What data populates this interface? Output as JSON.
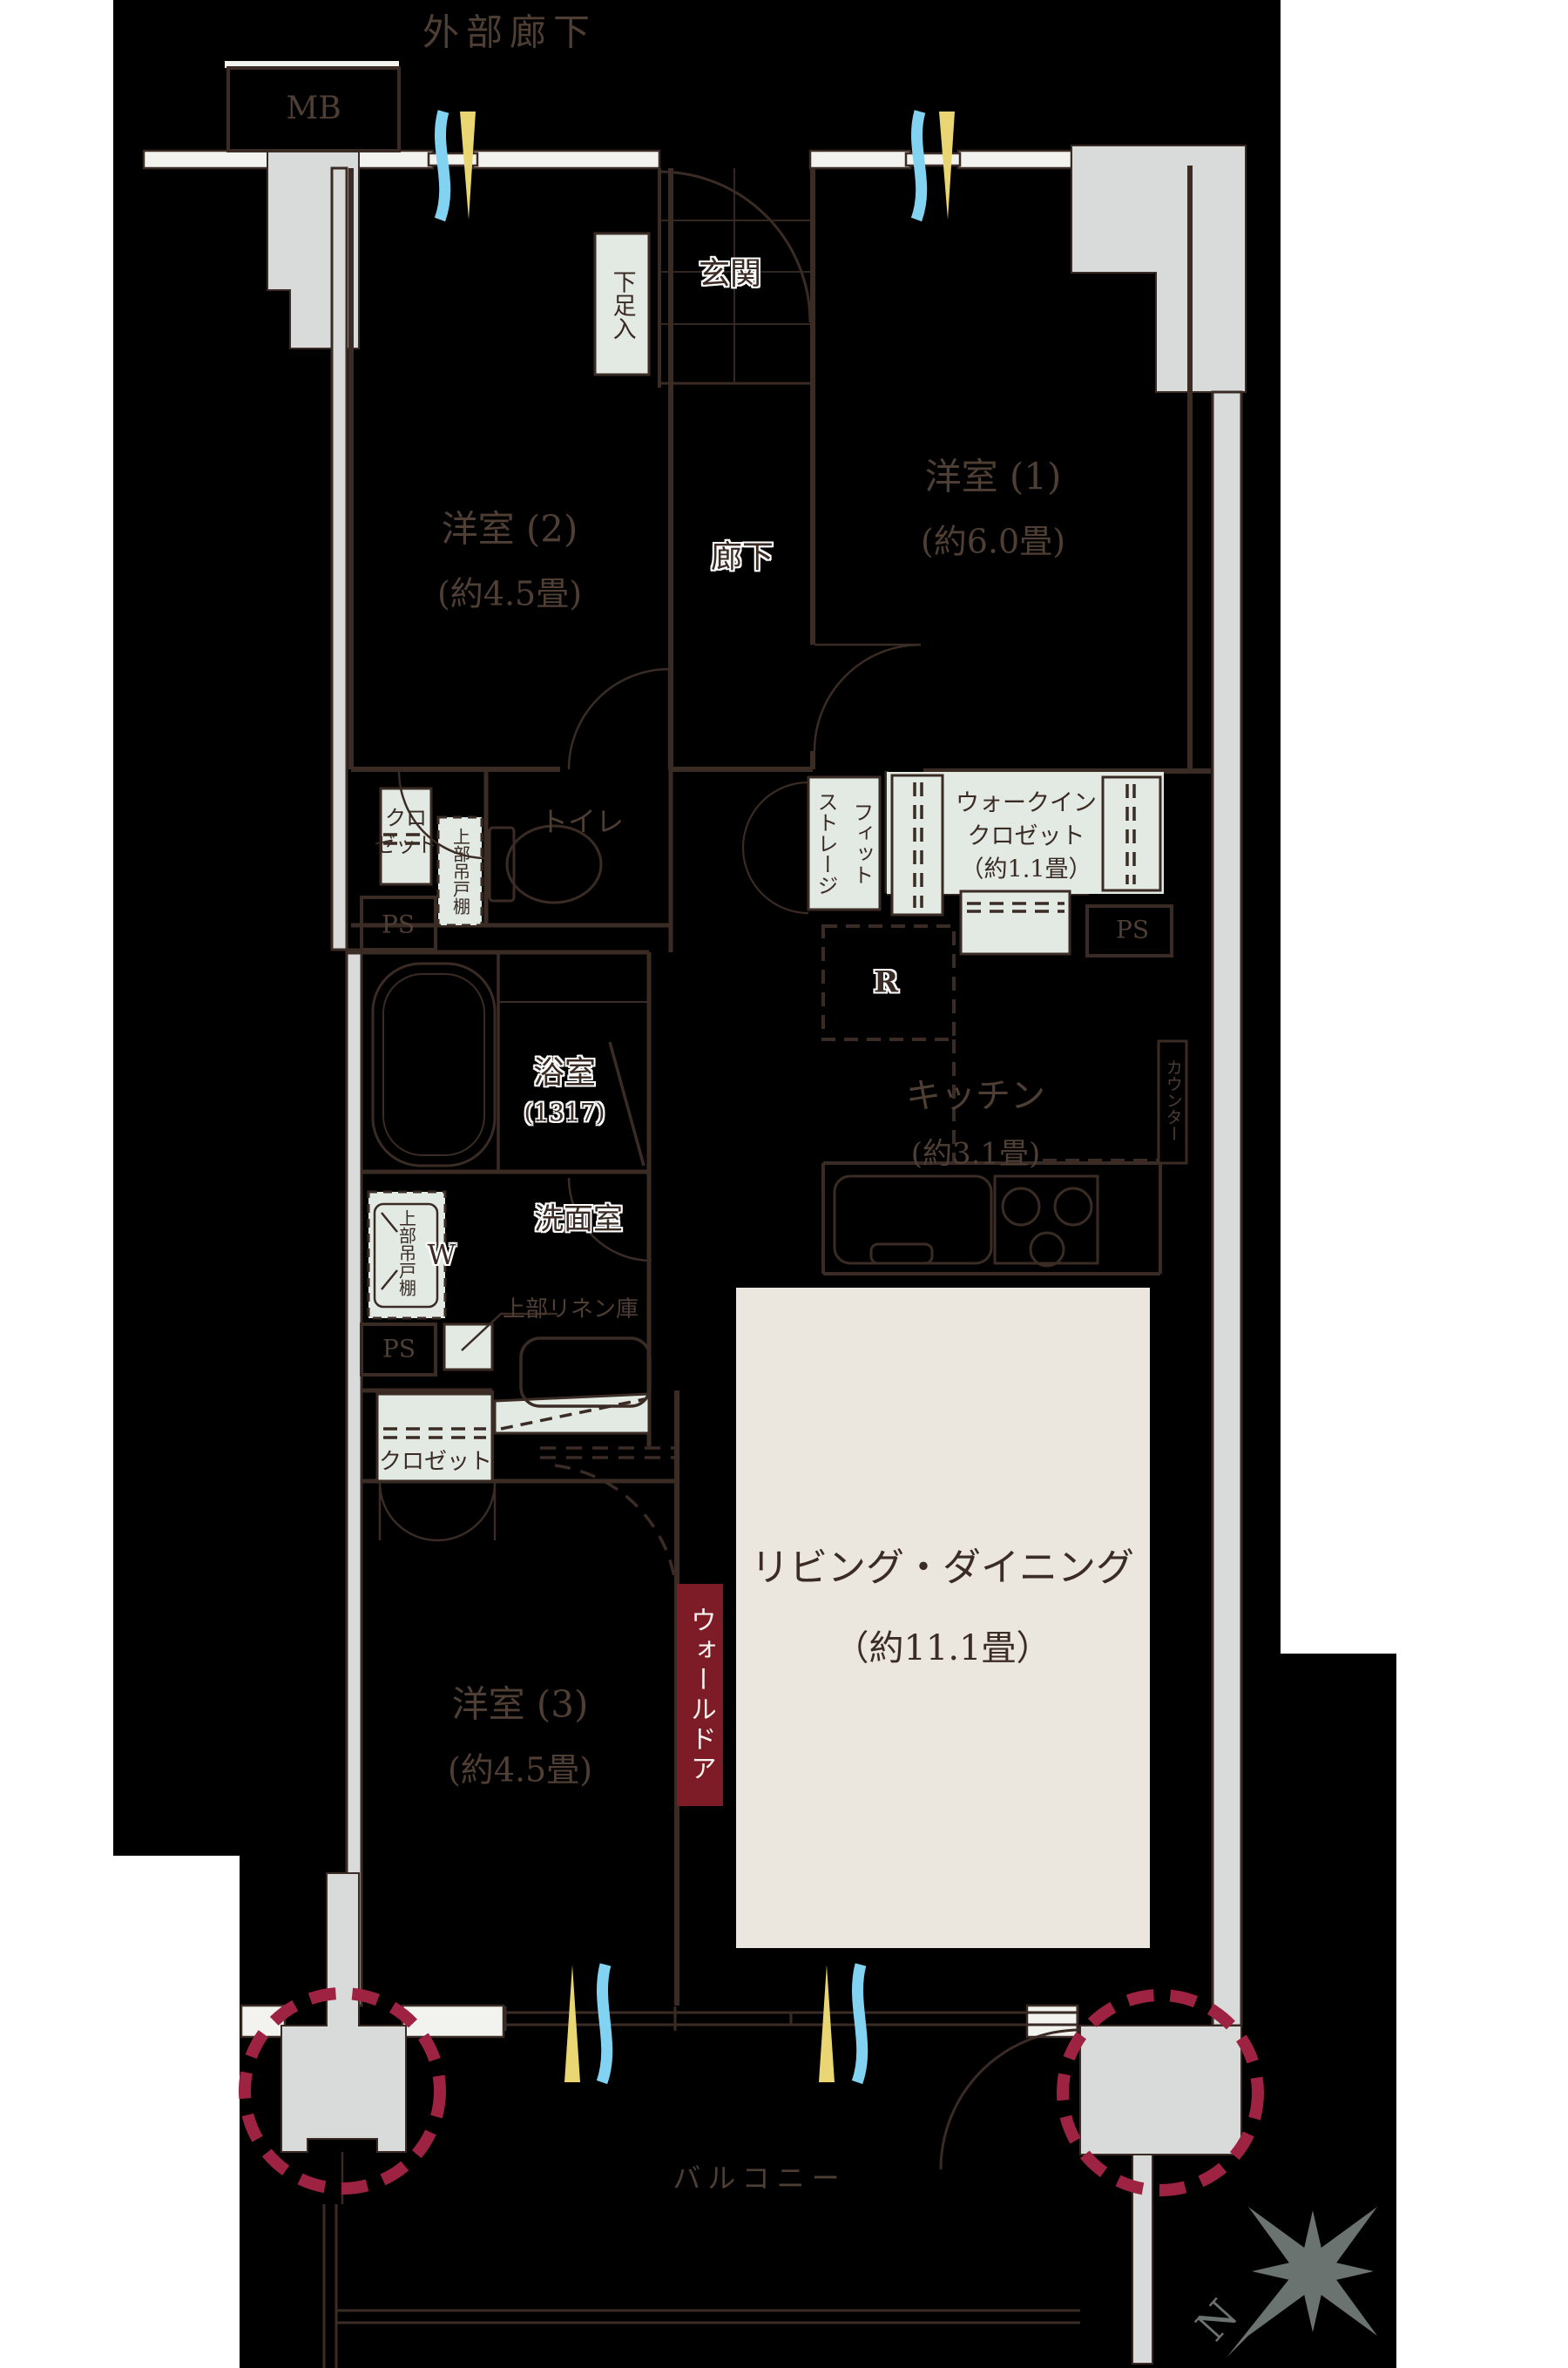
{
  "labels": {
    "exterior_corridor": "外部廊下",
    "mb": "MB",
    "entrance": "玄関",
    "shoe_cabinet": "下足入",
    "hallway": "廊下",
    "toilet": "トイレ",
    "closet_upper": "クロ\nゼット",
    "upper_cabinet_toilet": "上部吊戸棚",
    "ps": "PS",
    "fit_storage": "フィット\nストレージ",
    "wic": "ウォークイン\nクロゼット\n（約1.1畳）",
    "fridge": "R",
    "bathroom": "浴室",
    "bathroom_size": "(1317)",
    "kitchen": "キッチン",
    "kitchen_size": "(約3.1畳)",
    "counter": "カウンター",
    "washroom": "洗面室",
    "upper_cabinet_washer": "上部吊戸棚",
    "washer": "W",
    "upper_linen": "上部リネン庫",
    "closet_lower": "クロゼット",
    "wall_door": "ウォールドア",
    "balcony": "バルコニー",
    "compass_north": "N"
  },
  "rooms": [
    {
      "name": "洋室 (1)",
      "size": "(約6.0畳)"
    },
    {
      "name": "洋室 (2)",
      "size": "(約4.5畳)"
    },
    {
      "name": "洋室 (3)",
      "size": "(約4.5畳)"
    },
    {
      "name": "リビング・ダイニング",
      "size": "（約11.1畳）"
    }
  ],
  "colors": {
    "background": "#000000",
    "line": "#3a2b25",
    "wall_fill": "#f2f2ef",
    "pillar_gray": "#d9dbda",
    "storage_pale_green": "#e3eae3",
    "ld_cream": "#ece7de",
    "wall_door_red": "#7d1b26",
    "pillar_circle_red": "#9e2242",
    "vent_yellow": "#e9d572",
    "vent_blue": "#82d2f2",
    "compass_gray": "#6a7370"
  }
}
